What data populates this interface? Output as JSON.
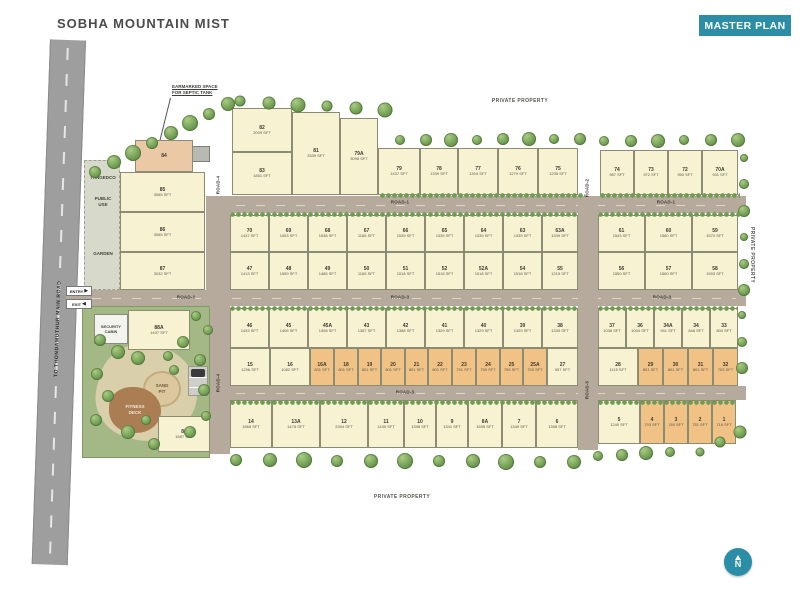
{
  "header": {
    "title": "SOBHA MOUNTAIN MIST",
    "badge": "MASTER PLAN"
  },
  "colors": {
    "teal": "#2b8ea6",
    "cream": "#f7f2d2",
    "orange": "#f0c285",
    "road": "#b5aa9c",
    "main_road": "#9e9e9e"
  },
  "boundary": {
    "private_top": "PRIVATE PROPERTY",
    "private_bottom": "PRIVATE PROPERTY",
    "private_right": "PRIVATE PROPERTY",
    "main_road": "TO THONDAMUTHUR MAIN ROAD"
  },
  "annotations": {
    "septic_line1": "EARMARKED SPACE",
    "septic_line2": "FOR SEPTIC TANK",
    "entry": "ENTRY",
    "exit": "EXIT",
    "entry_arrow": "▶",
    "exit_arrow": "◀",
    "tangedco": "TANGEDCO",
    "public_use_line1": "PUBLIC",
    "public_use_line2": "USE",
    "garden": "GARDEN",
    "security_line1": "SECURITY",
    "security_line2": "CABIN",
    "sand_line1": "SAND",
    "sand_line2": "PIT",
    "fitness_line1": "FITNESS",
    "fitness_line2": "DECK",
    "compass_n": "N"
  },
  "road_labels": [
    {
      "t": "ROAD-1",
      "x": 400,
      "y": 202,
      "v": false
    },
    {
      "t": "ROAD-1",
      "x": 666,
      "y": 202,
      "v": false
    },
    {
      "t": "ROAD-2",
      "x": 186,
      "y": 297,
      "v": false
    },
    {
      "t": "ROAD-3",
      "x": 400,
      "y": 297,
      "v": false
    },
    {
      "t": "ROAD-3",
      "x": 662,
      "y": 297,
      "v": false
    },
    {
      "t": "ROAD-3",
      "x": 405,
      "y": 392,
      "v": false
    },
    {
      "t": "ROAD-4",
      "x": 218,
      "y": 185,
      "v": true
    },
    {
      "t": "ROAD-4",
      "x": 218,
      "y": 383,
      "v": true
    },
    {
      "t": "ROAD-2",
      "x": 587,
      "y": 188,
      "v": true
    },
    {
      "t": "ROAD-5",
      "x": 587,
      "y": 390,
      "v": true
    }
  ],
  "plots": [
    [
      "84",
      "",
      135,
      140,
      58,
      32,
      "p"
    ],
    [
      "85",
      "3065 SFT",
      120,
      172,
      85,
      40,
      "c"
    ],
    [
      "86",
      "3065 SFT",
      120,
      212,
      85,
      40,
      "c"
    ],
    [
      "87",
      "3032 SFT",
      120,
      252,
      85,
      38,
      "c"
    ],
    [
      "82",
      "2009 SFT",
      232,
      108,
      60,
      44,
      "c"
    ],
    [
      "83",
      "1851 SFT",
      232,
      152,
      60,
      43,
      "c"
    ],
    [
      "81",
      "3339 SFT",
      292,
      112,
      48,
      83,
      "c"
    ],
    [
      "79A",
      "3098 SFT",
      340,
      118,
      38,
      77,
      "c"
    ],
    [
      "79",
      "1437 SFT",
      378,
      148,
      42,
      47,
      "c"
    ],
    [
      "78",
      "1339 SFT",
      420,
      148,
      38,
      47,
      "c"
    ],
    [
      "77",
      "1304 SFT",
      458,
      148,
      40,
      47,
      "c"
    ],
    [
      "76",
      "1279 SFT",
      498,
      148,
      40,
      47,
      "c"
    ],
    [
      "75",
      "1235 SFT",
      538,
      148,
      40,
      47,
      "c"
    ],
    [
      "74",
      "987 SFT",
      600,
      150,
      34,
      45,
      "c"
    ],
    [
      "73",
      "972 SFT",
      634,
      150,
      34,
      45,
      "c"
    ],
    [
      "72",
      "950 SFT",
      668,
      150,
      34,
      45,
      "c"
    ],
    [
      "70A",
      "931 SFT",
      702,
      150,
      36,
      45,
      "c"
    ],
    [
      "70",
      "1437 SFT",
      230,
      215,
      39,
      37,
      "c"
    ],
    [
      "69",
      "1553 SFT",
      269,
      215,
      39,
      37,
      "c"
    ],
    [
      "68",
      "1538 SFT",
      308,
      215,
      39,
      37,
      "c"
    ],
    [
      "67",
      "1185 SFT",
      347,
      215,
      39,
      37,
      "c"
    ],
    [
      "66",
      "1539 SFT",
      386,
      215,
      39,
      37,
      "c"
    ],
    [
      "65",
      "1339 SFT",
      425,
      215,
      39,
      37,
      "c"
    ],
    [
      "64",
      "1339 SFT",
      464,
      215,
      39,
      37,
      "c"
    ],
    [
      "63",
      "1339 SFT",
      503,
      215,
      39,
      37,
      "c"
    ],
    [
      "63A",
      "1339 SFT",
      542,
      215,
      36,
      37,
      "c"
    ],
    [
      "47",
      "1413 SFT",
      230,
      252,
      39,
      38,
      "c"
    ],
    [
      "48",
      "1559 SFT",
      269,
      252,
      39,
      38,
      "c"
    ],
    [
      "49",
      "1485 SFT",
      308,
      252,
      39,
      38,
      "c"
    ],
    [
      "50",
      "1165 SFT",
      347,
      252,
      39,
      38,
      "c"
    ],
    [
      "51",
      "1518 SFT",
      386,
      252,
      39,
      38,
      "c"
    ],
    [
      "52",
      "1518 SFT",
      425,
      252,
      39,
      38,
      "c"
    ],
    [
      "52A",
      "1518 SFT",
      464,
      252,
      39,
      38,
      "c"
    ],
    [
      "54",
      "1518 SFT",
      503,
      252,
      39,
      38,
      "c"
    ],
    [
      "55",
      "1215 SFT",
      542,
      252,
      36,
      38,
      "c"
    ],
    [
      "61",
      "1543 SFT",
      598,
      215,
      47,
      37,
      "c"
    ],
    [
      "60",
      "1580 SFT",
      645,
      215,
      47,
      37,
      "c"
    ],
    [
      "59",
      "1570 SFT",
      692,
      215,
      46,
      37,
      "c"
    ],
    [
      "56",
      "1550 SFT",
      598,
      252,
      47,
      38,
      "c"
    ],
    [
      "57",
      "1560 SFT",
      645,
      252,
      47,
      38,
      "c"
    ],
    [
      "58",
      "1593 SFT",
      692,
      252,
      46,
      38,
      "c"
    ],
    [
      "46",
      "1433 SFT",
      230,
      308,
      39,
      40,
      "c"
    ],
    [
      "45",
      "1406 SFT",
      269,
      308,
      39,
      40,
      "c"
    ],
    [
      "45A",
      "1308 SFT",
      308,
      308,
      39,
      40,
      "c"
    ],
    [
      "43",
      "1387 SFT",
      347,
      308,
      39,
      40,
      "c"
    ],
    [
      "42",
      "1388 SFT",
      386,
      308,
      39,
      40,
      "c"
    ],
    [
      "41",
      "1329 SFT",
      425,
      308,
      39,
      40,
      "c"
    ],
    [
      "40",
      "1329 SFT",
      464,
      308,
      39,
      40,
      "c"
    ],
    [
      "39",
      "1329 SFT",
      503,
      308,
      39,
      40,
      "c"
    ],
    [
      "38",
      "1339 SFT",
      542,
      308,
      36,
      40,
      "c"
    ],
    [
      "15",
      "1296 SFT",
      230,
      348,
      40,
      38,
      "c"
    ],
    [
      "16",
      "1082 SFT",
      270,
      348,
      40,
      38,
      "c"
    ],
    [
      "16A",
      "831 SFT",
      310,
      348,
      24,
      38,
      "o"
    ],
    [
      "18",
      "801 SFT",
      334,
      348,
      24,
      38,
      "o"
    ],
    [
      "19",
      "801 SFT",
      358,
      348,
      23,
      38,
      "o"
    ],
    [
      "20",
      "801 SFT",
      381,
      348,
      24,
      38,
      "o"
    ],
    [
      "21",
      "801 SFT",
      405,
      348,
      23,
      38,
      "o"
    ],
    [
      "22",
      "801 SFT",
      428,
      348,
      24,
      38,
      "o"
    ],
    [
      "23",
      "791 SFT",
      452,
      348,
      24,
      38,
      "o"
    ],
    [
      "24",
      "759 SFT",
      476,
      348,
      24,
      38,
      "o"
    ],
    [
      "25",
      "759 SFT",
      500,
      348,
      23,
      38,
      "o"
    ],
    [
      "25A",
      "793 SFT",
      523,
      348,
      24,
      38,
      "o"
    ],
    [
      "27",
      "657 SFT",
      547,
      348,
      31,
      38,
      "c"
    ],
    [
      "37",
      "1038 SFT",
      598,
      308,
      28,
      40,
      "c"
    ],
    [
      "36",
      "1004 SFT",
      626,
      308,
      28,
      40,
      "c"
    ],
    [
      "34A",
      "941 SFT",
      654,
      308,
      28,
      40,
      "c"
    ],
    [
      "34",
      "848 SFT",
      682,
      308,
      28,
      40,
      "c"
    ],
    [
      "33",
      "800 SFT",
      710,
      308,
      28,
      40,
      "c"
    ],
    [
      "28",
      "1115 SFT",
      598,
      348,
      40,
      38,
      "c"
    ],
    [
      "29",
      "801 SFT",
      638,
      348,
      25,
      38,
      "o"
    ],
    [
      "30",
      "801 SFT",
      663,
      348,
      25,
      38,
      "o"
    ],
    [
      "31",
      "801 SFT",
      688,
      348,
      25,
      38,
      "o"
    ],
    [
      "32",
      "793 SFT",
      713,
      348,
      25,
      38,
      "o"
    ],
    [
      "14",
      "1865 SFT",
      230,
      400,
      42,
      48,
      "c"
    ],
    [
      "13A",
      "1478 SFT",
      272,
      400,
      48,
      48,
      "c"
    ],
    [
      "12",
      "2394 SFT",
      320,
      400,
      48,
      48,
      "c"
    ],
    [
      "11",
      "1439 SFT",
      368,
      400,
      36,
      48,
      "c"
    ],
    [
      "10",
      "1398 SFT",
      404,
      400,
      32,
      48,
      "c"
    ],
    [
      "9",
      "1341 SFT",
      436,
      400,
      32,
      48,
      "c"
    ],
    [
      "8A",
      "1595 SFT",
      468,
      400,
      34,
      48,
      "c"
    ],
    [
      "7",
      "1349 SFT",
      502,
      400,
      34,
      48,
      "c"
    ],
    [
      "6",
      "1398 SFT",
      536,
      400,
      42,
      48,
      "c"
    ],
    [
      "5",
      "1240 SFT",
      598,
      400,
      42,
      44,
      "c"
    ],
    [
      "4",
      "793 SFT",
      640,
      400,
      24,
      44,
      "o"
    ],
    [
      "3",
      "760 SFT",
      664,
      400,
      24,
      44,
      "o"
    ],
    [
      "2",
      "751 SFT",
      688,
      400,
      24,
      44,
      "o"
    ],
    [
      "1",
      "718 SFT",
      712,
      400,
      24,
      44,
      "o"
    ],
    [
      "88A",
      "1497 SFT",
      128,
      310,
      62,
      40,
      "c"
    ],
    [
      "88",
      "1587 SFT",
      158,
      416,
      52,
      36,
      "c"
    ]
  ]
}
